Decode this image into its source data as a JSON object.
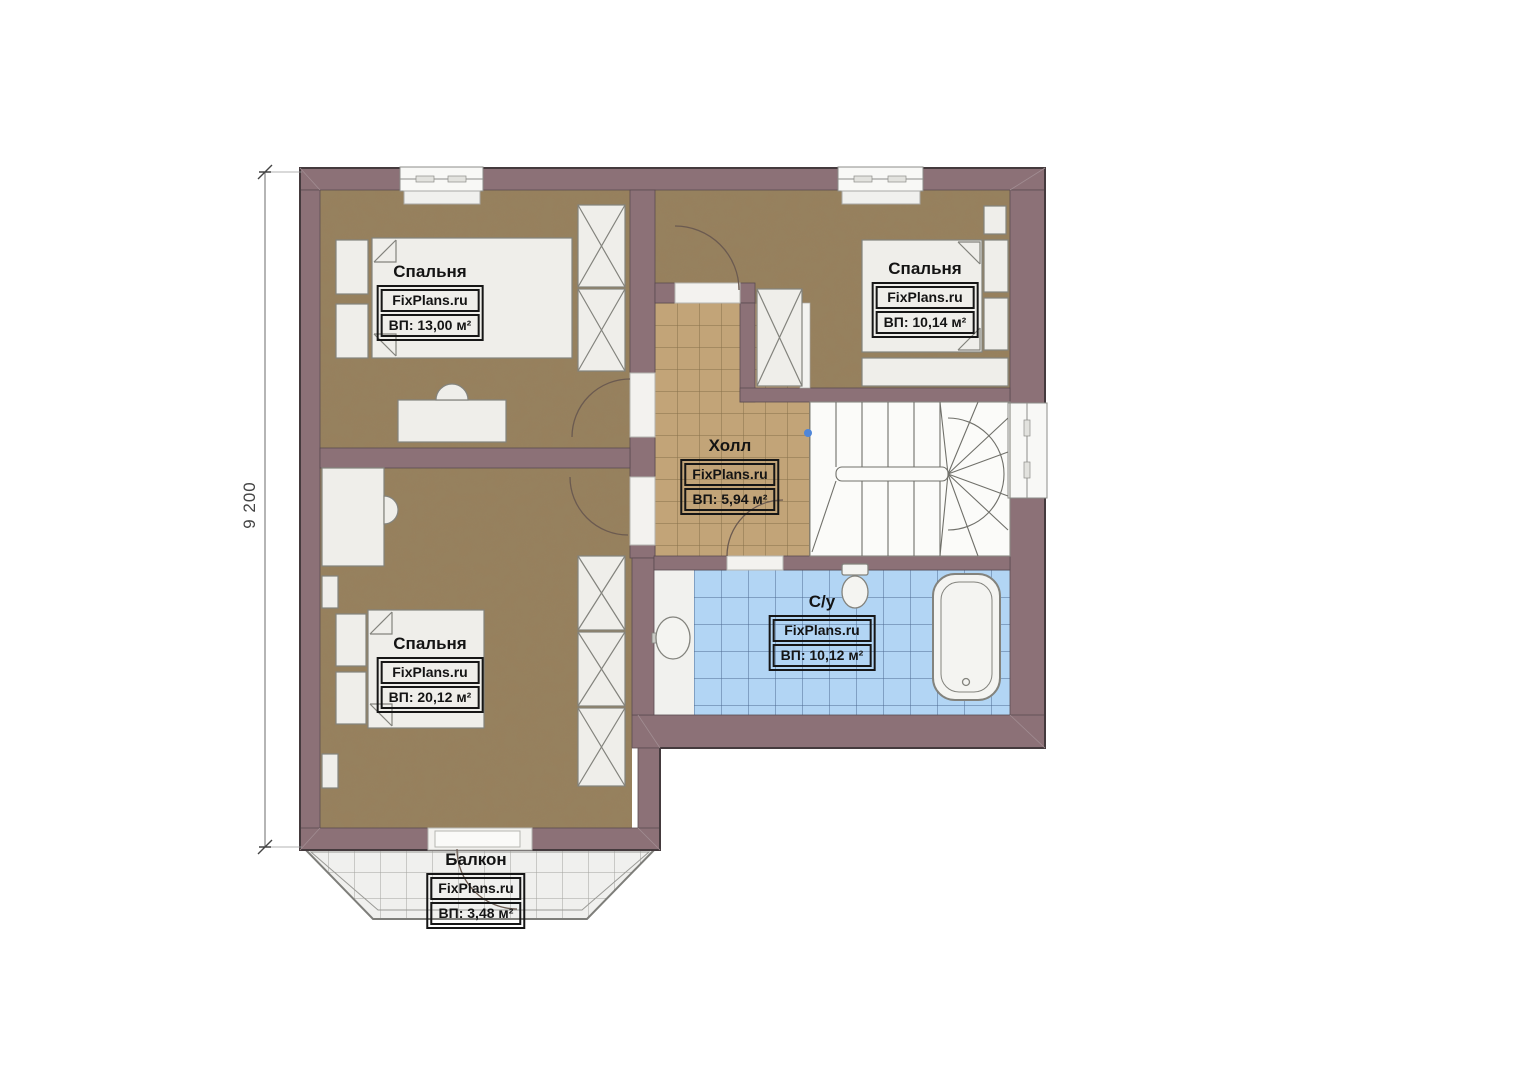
{
  "watermark": "FixPlans.ru",
  "dimension": {
    "left_mm": "9 200"
  },
  "rooms": [
    {
      "id": "bedroom-top-left",
      "name": "Спальня",
      "area": "ВП: 13,00 м²"
    },
    {
      "id": "bedroom-top-right",
      "name": "Спальня",
      "area": "ВП: 10,14 м²"
    },
    {
      "id": "hall",
      "name": "Холл",
      "area": "ВП: 5,94 м²"
    },
    {
      "id": "bathroom",
      "name": "С/у",
      "area": "ВП: 10,12 м²"
    },
    {
      "id": "bedroom-bottom-left",
      "name": "Спальня",
      "area": "ВП: 20,12 м²"
    },
    {
      "id": "balcony",
      "name": "Балкон",
      "area": "ВП: 3,48 м²"
    }
  ],
  "colors": {
    "wall": "#8c7177",
    "outline": "#443a3d",
    "bedroom_floor": "#97805d",
    "hall_tile": "#c2a478",
    "bath_tile": "#b2d5f4",
    "balcony_tile": "#f0f0ee",
    "label_text": "#141414"
  }
}
